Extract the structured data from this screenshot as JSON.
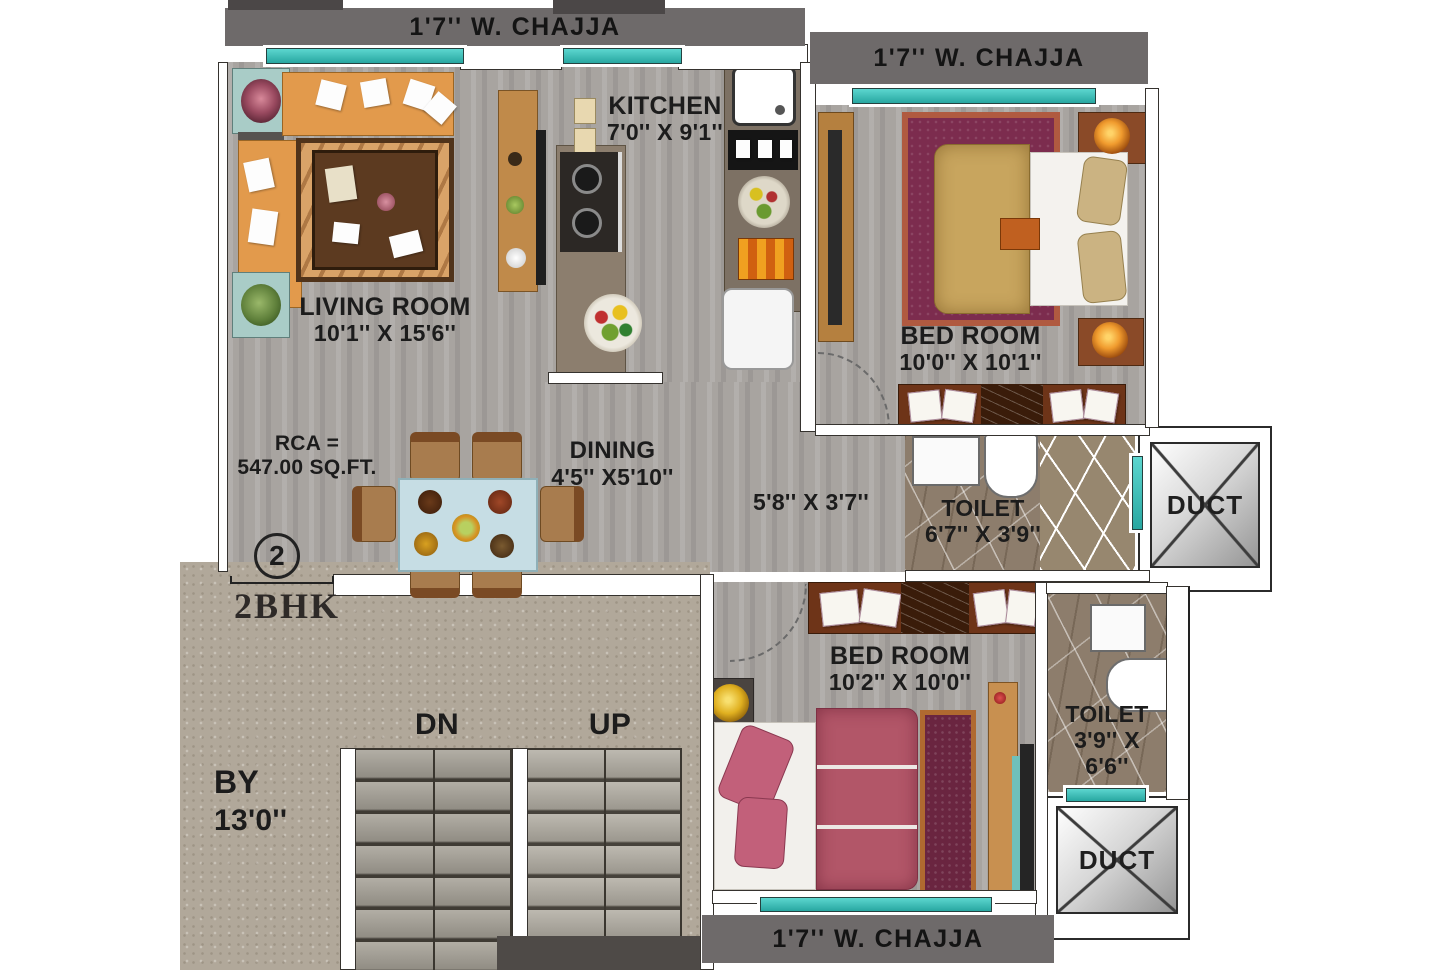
{
  "plan": {
    "chajja_top": "1'7'' W. CHAJJA",
    "chajja_top_right": "1'7'' W. CHAJJA",
    "chajja_bottom": "1'7'' W. CHAJJA",
    "living": {
      "name": "LIVING ROOM",
      "dims": "10'1'' X 15'6''"
    },
    "kitchen": {
      "name": "KITCHEN",
      "dims": "7'0'' X 9'1''"
    },
    "bedroom1": {
      "name": "BED ROOM",
      "dims": "10'0'' X 10'1''"
    },
    "bedroom2": {
      "name": "BED ROOM",
      "dims": "10'2'' X 10'0''"
    },
    "dining": {
      "name": "DINING",
      "dims": "4'5'' X5'10''"
    },
    "passage": {
      "dims": "5'8'' X 3'7''"
    },
    "toilet1": {
      "name": "TOILET",
      "dims": "6'7'' X 3'9''"
    },
    "toilet2": {
      "name": "TOILET",
      "dims_line1": "3'9'' X",
      "dims_line2": "6'6''"
    },
    "duct1_label": "DUCT",
    "duct2_label": "DUCT",
    "stairs": {
      "down": "DN",
      "up": "UP"
    },
    "lobby": {
      "name": "BY",
      "dims": "13'0''"
    },
    "unit": {
      "number": "2",
      "type": "2BHK"
    },
    "rca": {
      "line1": "RCA =",
      "line2": "547.00 SQ.FT."
    }
  },
  "colors": {
    "window_teal": "#3fc8c2",
    "chajja_gray": "#6e6a6a",
    "floor_gray": "#a8a4a0",
    "lobby_floor": "#b1a89a",
    "toilet_brown": "#8d7d6c",
    "sofa_orange": "#e29a4c",
    "rug1_maroon": "#7c2c4e",
    "bed1_tan": "#c8a55e",
    "bed2_pink": "#b25668",
    "wardrobe_brown": "#6e3418"
  }
}
